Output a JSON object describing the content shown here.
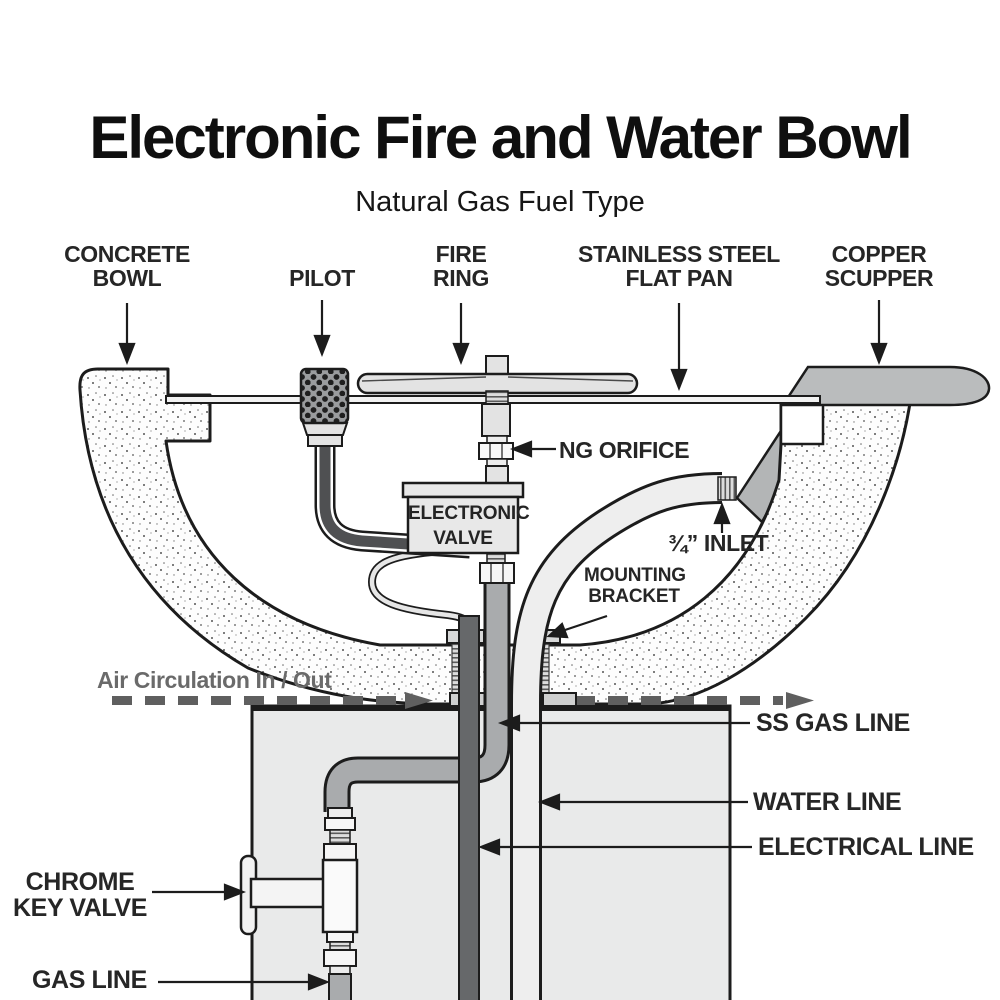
{
  "page": {
    "title": "Electronic Fire and Water Bowl",
    "subtitle": "Natural Gas Fuel Type"
  },
  "labels": {
    "concrete_bowl": "CONCRETE BOWL",
    "pilot": "PILOT",
    "fire_ring": "FIRE RING",
    "flat_pan": "STAINLESS STEEL FLAT PAN",
    "copper_scupper": "COPPER SCUPPER",
    "ng_orifice": "NG ORIFICE",
    "electronic_valve": "ELECTRONIC VALVE",
    "inlet": "¾” INLET",
    "mounting_bracket": "MOUNTING BRACKET",
    "air_circulation": "Air Circulation In / Out",
    "ss_gas_line": "SS GAS LINE",
    "water_line": "WATER LINE",
    "electrical_line": "ELECTRICAL LINE",
    "chrome_key_valve": "CHROME KEY VALVE",
    "gas_line": "GAS LINE"
  },
  "colors": {
    "ink": "#1c1c1c",
    "label_gray": "#6a6a6a",
    "pedestal_fill": "#e9eaea",
    "pipe_gray": "#a9abad",
    "electrical_dark": "#66686a",
    "metal_light": "#e6e6e6",
    "scupper_gray": "#babcbd",
    "dash_gray": "#5f5f5f"
  }
}
